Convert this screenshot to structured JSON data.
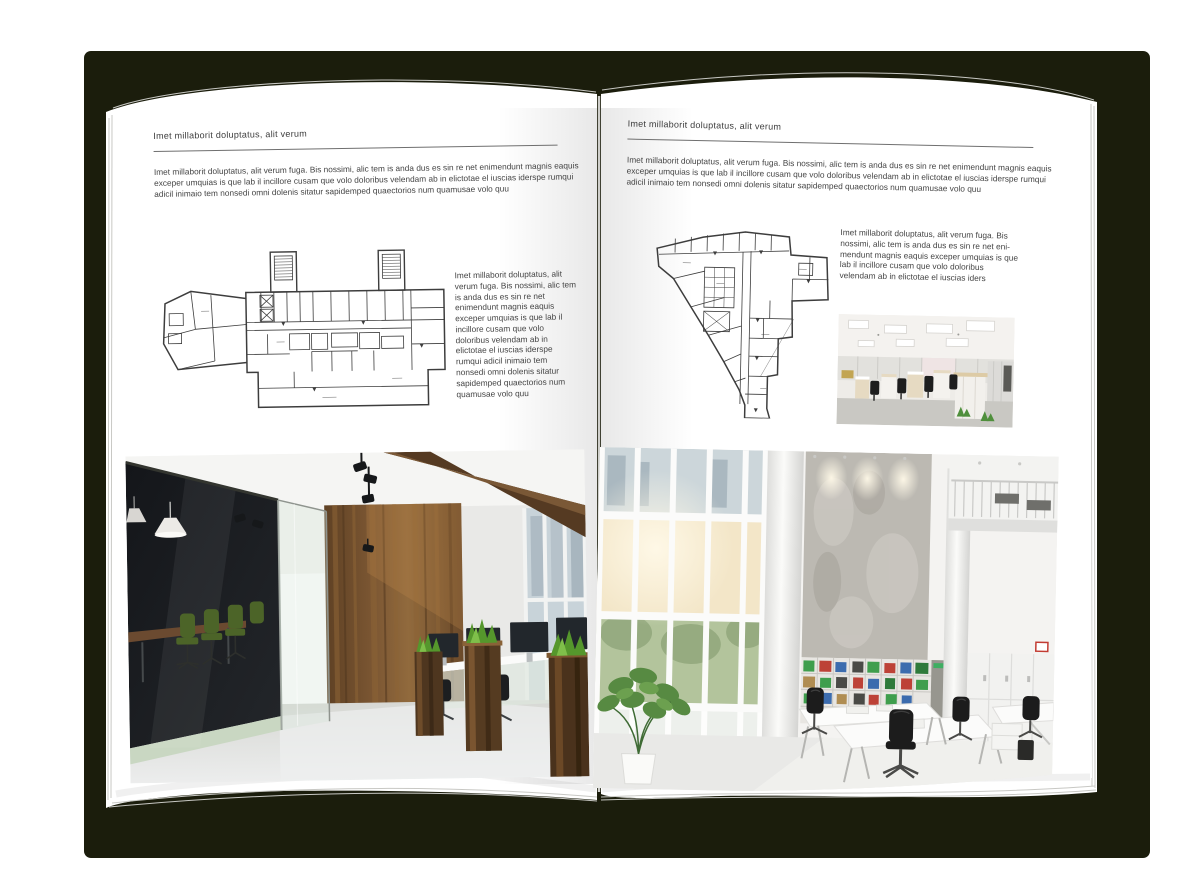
{
  "palette": {
    "backdrop": "#ffffff",
    "book_shadow": "#1b1d0c",
    "page": "#ffffff",
    "text": "#3d3d3d"
  },
  "left_page": {
    "header": "Imet millaborit doluptatus, alit verum",
    "intro": "Imet millaborit doluptatus, alit verum fuga. Bis nossimi, alic tem is anda dus es sin re net enimendunt magnis eaquis exceper umquias is que lab il incillore cusam que volo doloribus velendam ab in elictotae el iuscias iderspe rumqui adicil inimaio tem nonsedi omni dolenis sitatur sapidemped quaectorios num quamusae volo quu",
    "side_text": "Imet millaborit doluptatus, alit verum fuga. Bis nossimi, alic tem is anda dus es sin re net enimendunt magnis eaquis exceper umquias is que lab il incillore cusam que volo doloribus velendam ab in elictotae el iuscias iderspe rumqui adicil inimaio tem nonsedi omni dolenis sitatur sapidemped quaectorios num quamusae volo quu",
    "floor_plan_alt": "wide building floor plan with two stair towers and angled left wing",
    "photo_alt": "open office with dark glass meeting room, green chairs, wood wall, planters and desks"
  },
  "right_page": {
    "header": "Imet millaborit doluptatus, alit verum",
    "intro": "Imet millaborit doluptatus, alit verum fuga. Bis nossimi, alic tem is anda dus es sin re net enimendunt magnis eaquis exceper umquias is que lab il incillore cusam que volo doloribus velendam ab in elictotae el iuscias iderspe rumqui adicil inimaio tem nonsedi omni dolenis sitatur sapidemped quaectorios num quamusae volo quu",
    "side_text": "Imet millaborit doluptatus, alit verum fuga. Bis nossimi, alic tem is anda dus es sin re net eni-mendunt magnis eaquis exceper umquias is que lab il incillore cusam que volo doloribus velendam ab in elictotae el iuscias iders",
    "floor_plan_alt": "tapering tower floor plan with core and bottom stem",
    "photo_small_alt": "cubicle office with ceiling light panels and black chairs",
    "photo_alt": "bright double-height office with window wall, concrete pillar wall, binder shelves and white desks"
  }
}
